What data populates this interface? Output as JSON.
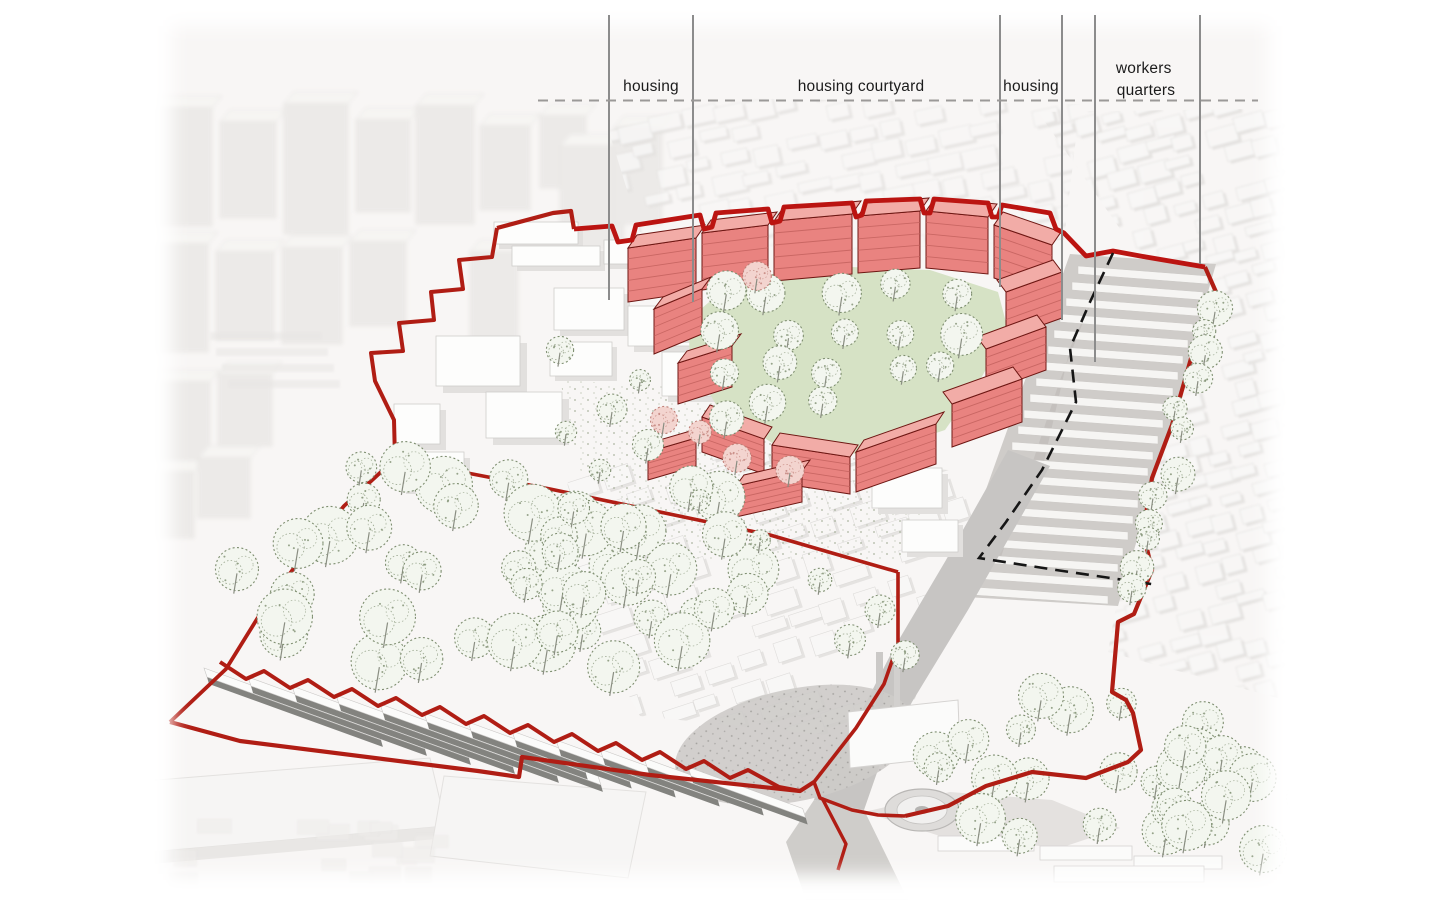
{
  "annotations": {
    "callouts": [
      {
        "id": "housing-left",
        "label": "housing"
      },
      {
        "id": "housing-courtyard",
        "label": "housing courtyard"
      },
      {
        "id": "housing-right",
        "label": "housing"
      },
      {
        "id": "workers-quarters",
        "label": "workers quarters",
        "line1": "workers",
        "line2": "quarters"
      }
    ]
  },
  "palette": {
    "highlight_red": "#e98380",
    "roof_red": "#f2aca7",
    "boundary_red": "#b01d14",
    "bright_red": "#bb1411",
    "courtyard_green": "#d6e2c5",
    "tree_green": "#7e8e70",
    "massing_gray": "#eceae8",
    "road_gray": "#c9c7c5",
    "annotation_gray": "#8c8c8c",
    "dashed_black": "#161616"
  }
}
